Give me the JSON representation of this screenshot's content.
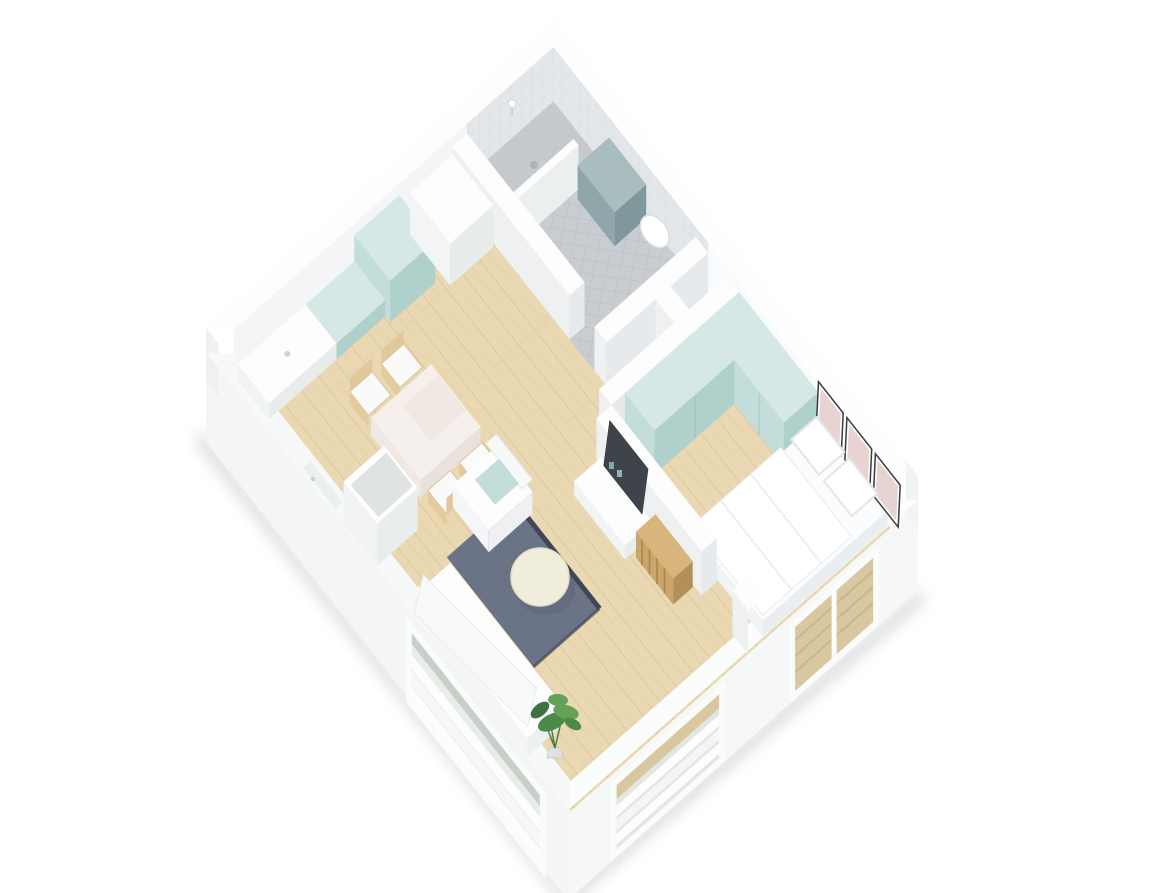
{
  "scene": {
    "title": "3D isometric dollhouse render of a one-bedroom apartment floor plan",
    "view": "isometric cutaway, viewed from the south-west above, white background",
    "rooms": [
      {
        "name": "living-dining-kitchen",
        "objects": [
          "kitchen counter",
          "mint tall cabinet",
          "mint base cabinets",
          "white closet",
          "dining table",
          "four wooden chairs",
          "white armchair with mint pillow",
          "dark gray rug",
          "round cream coffee table",
          "white sofa",
          "white column",
          "tv sideboard",
          "tv panel",
          "wood slat radiator",
          "potted plant"
        ]
      },
      {
        "name": "bathroom",
        "objects": [
          "walk-in shower",
          "shower partition",
          "shower head",
          "teal cabinet",
          "wall-hung sink",
          "toilet",
          "gray mosaic floor",
          "gray tiled walls"
        ]
      },
      {
        "name": "bedroom",
        "objects": [
          "double bed with white bedding",
          "two pillows",
          "mint l-shaped wardrobe",
          "white bench",
          "three framed pictures"
        ]
      },
      {
        "name": "shaft-niche",
        "objects": []
      }
    ],
    "openings": [
      "bathroom door",
      "bedroom door",
      "entrance recess",
      "living room window with radiator",
      "sofa windows with blinds",
      "bedroom window with blinds",
      "lower bedroom window with radiator"
    ]
  },
  "colors": {
    "bg": "#ffffff",
    "wall_top": "#fdfdfe",
    "face_sw": "#eef0f2",
    "face_se": "#e7eaec",
    "face_nw_inner": "#f3f5f6",
    "face_ne_inner": "#fafbfc",
    "facade_sw": "#f3f5f6",
    "facade_se": "#f6f8f8",
    "wood": "#e9d8b1",
    "wood_line": "#d8c094",
    "wood_line2": "#e3cfa6",
    "tile": "#c9cdd1",
    "tile_line": "#b9bec3",
    "wall_tile": "#e4e7e9",
    "wall_tile_line": "#d6dadd",
    "shower_floor": "#c2c7ca",
    "mint_top": "#d6e8e5",
    "mint_front": "#c3ddda",
    "mint_side": "#b0d0cc",
    "teal_top": "#a9bdbf",
    "teal_front": "#8fa7aa",
    "teal_side": "#7e989c",
    "rug": "#6b7486",
    "rug_dot": "#616b7e",
    "rug_edge": "#3f4754",
    "cream": "#f0edda",
    "cream_edge": "#e2dec6",
    "chair_wood": "#e0c89c",
    "table_top": "#f6f0ec",
    "table_sw": "#efe8e4",
    "table_se": "#e9e1dc",
    "radiator_wood": "#caa66c",
    "radiator_side": "#b3905a",
    "radiator_top": "#d7b57c",
    "radiator_line": "#aa8748",
    "tv": "#3f444a",
    "blind": "#d9c89f",
    "blind_line": "#c9b78b",
    "art": "#e7d4d2",
    "frame_edge": "#3c3c3c",
    "plant": "#4d8a4a",
    "plant_light": "#63a257",
    "plant_dark": "#3c7340",
    "shadow": "#cdd0d1",
    "white": "#ffffff"
  }
}
